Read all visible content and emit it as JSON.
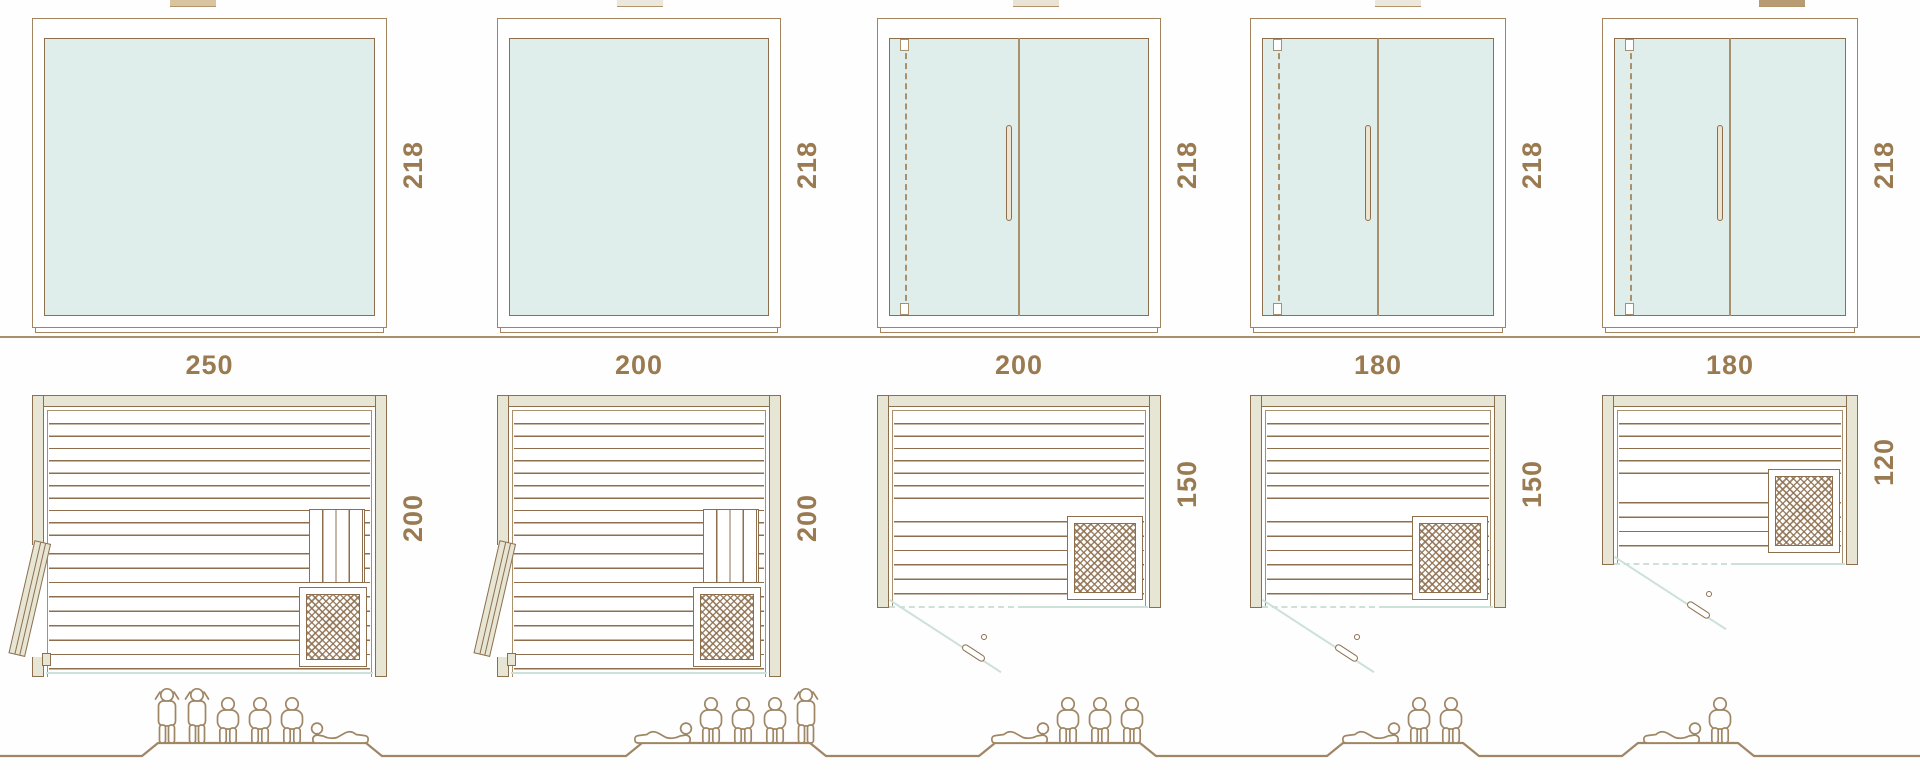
{
  "diagram": {
    "subject": "sauna model size comparison",
    "views": [
      "front-elevation",
      "floor-plan",
      "capacity-figures"
    ]
  },
  "colors": {
    "line_brown": "#8d6f4e",
    "frame_tan": "#a2855f",
    "dimension_text": "#9a7a50",
    "glass_fill": "#dfeeea",
    "wall_fill": "#e7e5d4",
    "glass_accent_blue": "#cde1da"
  },
  "units": [
    {
      "front": {
        "width_label": "250",
        "height_label": "218",
        "door": "fixed glass panel"
      },
      "plan": {
        "depth_label": "200",
        "door": "hinged side door",
        "heater": "bottom-right"
      },
      "capacity": {
        "count": 6,
        "figures": [
          "standing",
          "standing",
          "sitting",
          "sitting",
          "sitting",
          "lying-mirrored"
        ]
      }
    },
    {
      "front": {
        "width_label": "200",
        "height_label": "218",
        "door": "fixed glass panel"
      },
      "plan": {
        "depth_label": "200",
        "door": "hinged side door",
        "heater": "bottom-right"
      },
      "capacity": {
        "count": 5,
        "figures": [
          "lying",
          "sitting",
          "sitting",
          "sitting",
          "standing"
        ]
      }
    },
    {
      "front": {
        "width_label": "200",
        "height_label": "218",
        "door": "double glass door with handle"
      },
      "plan": {
        "depth_label": "150",
        "door": "front glass door",
        "heater": "bottom-right"
      },
      "capacity": {
        "count": 4,
        "figures": [
          "lying",
          "sitting",
          "sitting",
          "sitting"
        ]
      }
    },
    {
      "front": {
        "width_label": "180",
        "height_label": "218",
        "door": "double glass door with handle"
      },
      "plan": {
        "depth_label": "150",
        "door": "front glass door",
        "heater": "bottom-right"
      },
      "capacity": {
        "count": 3,
        "figures": [
          "lying",
          "sitting",
          "sitting"
        ]
      }
    },
    {
      "front": {
        "width_label": "180",
        "height_label": "218",
        "door": "double glass door with handle"
      },
      "plan": {
        "depth_label": "120",
        "door": "front glass door",
        "heater": "bottom-right"
      },
      "capacity": {
        "count": 2,
        "figures": [
          "lying",
          "sitting"
        ]
      }
    }
  ]
}
